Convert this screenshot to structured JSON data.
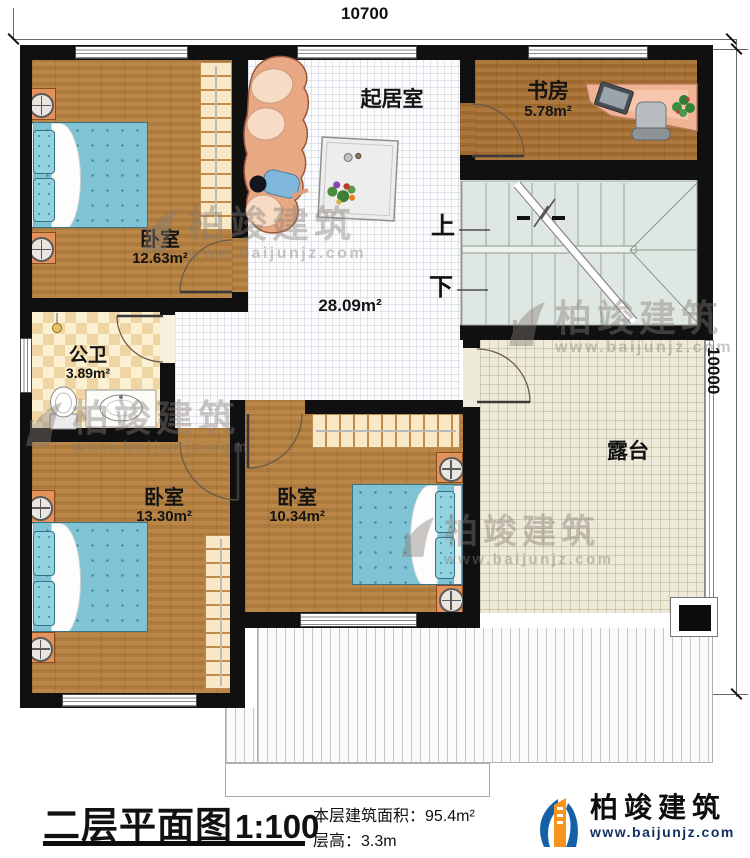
{
  "dimensions": {
    "top": "10700",
    "right": "10000"
  },
  "rooms": {
    "bedroom_tl": {
      "name": "卧室",
      "area": "12.63m²"
    },
    "living": {
      "name": "起居室",
      "area": "28.09m²"
    },
    "study": {
      "name": "书房",
      "area": "5.78m²"
    },
    "bath": {
      "name": "公卫",
      "area": "3.89m²"
    },
    "bedroom_bl": {
      "name": "卧室",
      "area": "13.30m²"
    },
    "bedroom_bm": {
      "name": "卧室",
      "area": "10.34m²"
    },
    "terrace": {
      "name": "露台"
    }
  },
  "stairs": {
    "up_label": "上",
    "down_label": "下"
  },
  "title": {
    "name": "二层平面图",
    "scale": "1:100"
  },
  "info": {
    "area_label": "本层建筑面积：",
    "area_value": "95.4m²",
    "height_label": "层高：",
    "height_value": "3.3m"
  },
  "brand": {
    "name": "柏竣建筑",
    "site": "www.baijunjz.com"
  },
  "watermark": {
    "name": "柏竣建筑",
    "site": "www.baijunjz.com"
  },
  "colors": {
    "wall": "#101010",
    "wood": "#b5803f",
    "bed": "#7fc3d4",
    "terrace_floor": "#eeead9",
    "brand_blue": "#1660a8",
    "brand_orange": "#f7941d"
  }
}
